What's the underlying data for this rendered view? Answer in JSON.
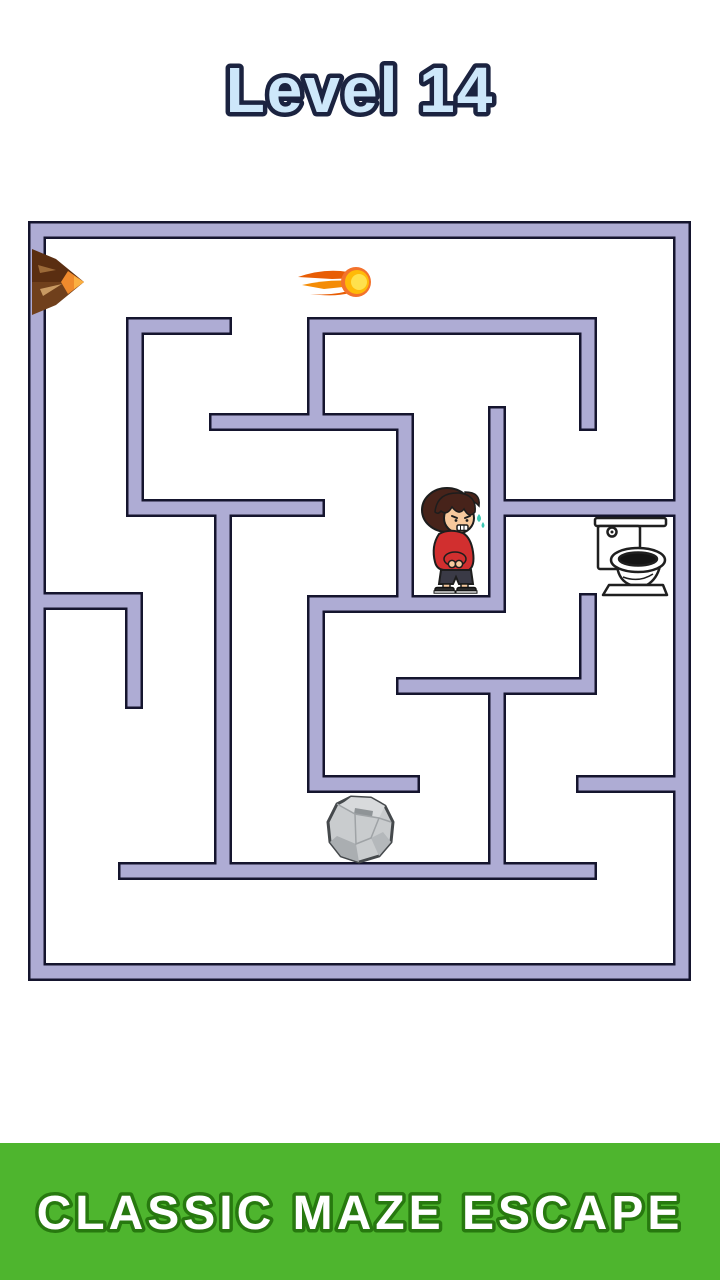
{
  "title": {
    "text": "Level 14",
    "fill": "#cde7fa",
    "stroke": "#1b2340",
    "stroke_width": 9
  },
  "banner": {
    "text": "CLASSIC MAZE ESCAPE",
    "bg": "#4eb52e",
    "text_fill": "#ffffff",
    "text_stroke": "#27790f",
    "stroke_width": 7
  },
  "maze": {
    "wall_fill": "#aeacd4",
    "wall_outline": "#15152e",
    "wall_width": 13,
    "outline_extra": 5,
    "outer": {
      "x": 37,
      "y": 230,
      "w": 645,
      "h": 742
    },
    "walls": [
      {
        "x1": 135,
        "y1": 326,
        "x2": 223,
        "y2": 326
      },
      {
        "x1": 135,
        "y1": 326,
        "x2": 135,
        "y2": 508
      },
      {
        "x1": 135,
        "y1": 508,
        "x2": 316,
        "y2": 508
      },
      {
        "x1": 223,
        "y1": 508,
        "x2": 223,
        "y2": 871
      },
      {
        "x1": 218,
        "y1": 422,
        "x2": 405,
        "y2": 422
      },
      {
        "x1": 316,
        "y1": 326,
        "x2": 316,
        "y2": 422
      },
      {
        "x1": 405,
        "y1": 422,
        "x2": 405,
        "y2": 604
      },
      {
        "x1": 316,
        "y1": 326,
        "x2": 588,
        "y2": 326
      },
      {
        "x1": 588,
        "y1": 326,
        "x2": 588,
        "y2": 422
      },
      {
        "x1": 497,
        "y1": 415,
        "x2": 497,
        "y2": 604
      },
      {
        "x1": 316,
        "y1": 604,
        "x2": 497,
        "y2": 604
      },
      {
        "x1": 316,
        "y1": 604,
        "x2": 316,
        "y2": 784
      },
      {
        "x1": 316,
        "y1": 784,
        "x2": 411,
        "y2": 784
      },
      {
        "x1": 497,
        "y1": 508,
        "x2": 682,
        "y2": 508
      },
      {
        "x1": 588,
        "y1": 602,
        "x2": 588,
        "y2": 686
      },
      {
        "x1": 405,
        "y1": 686,
        "x2": 588,
        "y2": 686
      },
      {
        "x1": 497,
        "y1": 686,
        "x2": 497,
        "y2": 871
      },
      {
        "x1": 127,
        "y1": 871,
        "x2": 588,
        "y2": 871
      },
      {
        "x1": 585,
        "y1": 784,
        "x2": 682,
        "y2": 784
      },
      {
        "x1": 37,
        "y1": 601,
        "x2": 134,
        "y2": 601
      },
      {
        "x1": 134,
        "y1": 601,
        "x2": 134,
        "y2": 700
      }
    ]
  },
  "objects": {
    "volcano-icon": {
      "x": 30,
      "y": 249,
      "w": 58,
      "h": 66
    },
    "fireball-icon": {
      "x": 296,
      "y": 264,
      "w": 80,
      "h": 36
    },
    "player-character": {
      "x": 419,
      "y": 486,
      "w": 70,
      "h": 108
    },
    "toilet-goal": {
      "x": 589,
      "y": 515,
      "w": 80,
      "h": 86
    },
    "rock-obstacle": {
      "x": 325,
      "y": 794,
      "w": 72,
      "h": 70
    }
  }
}
